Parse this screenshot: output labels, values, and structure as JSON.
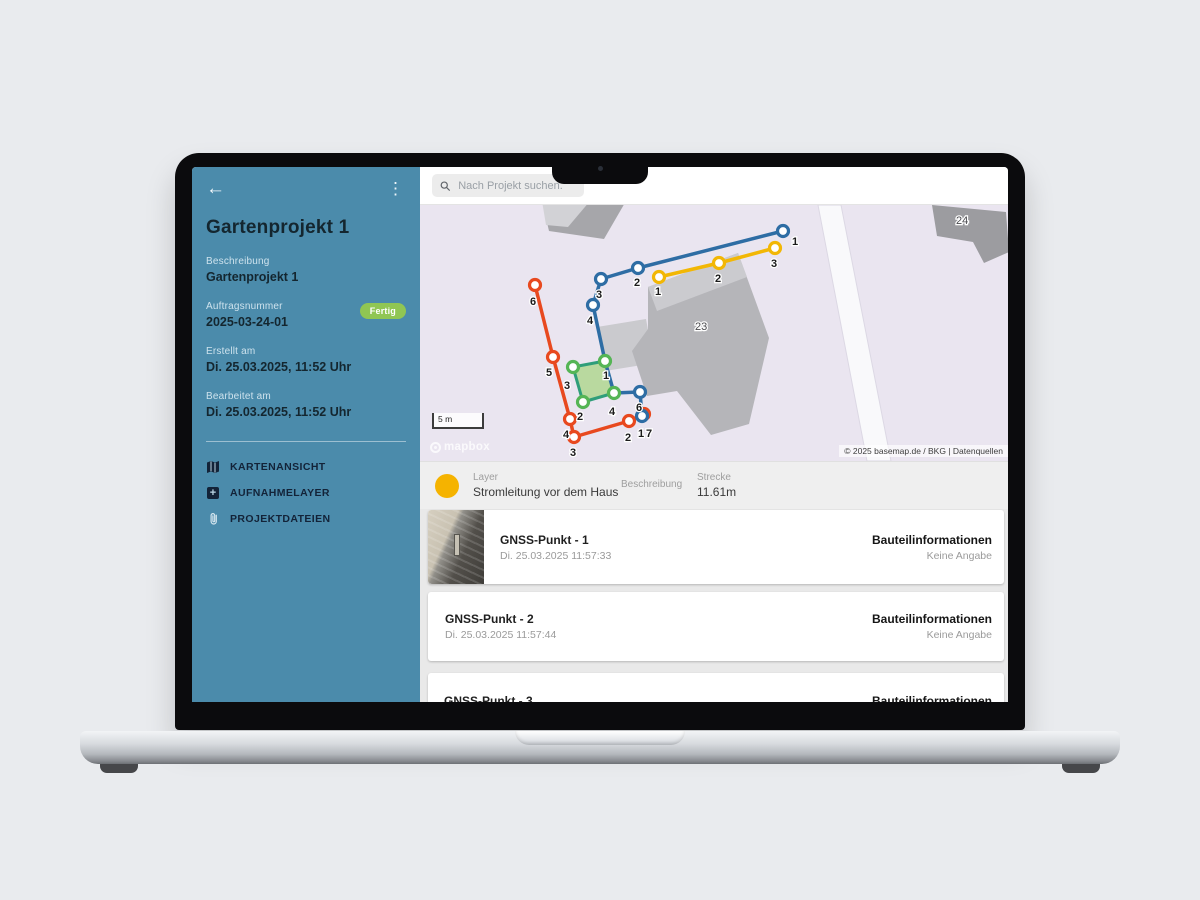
{
  "header": {
    "search_placeholder": "Nach Projekt suchen."
  },
  "sidebar": {
    "title": "Gartenprojekt 1",
    "fields": [
      {
        "label": "Beschreibung",
        "value": "Gartenprojekt 1"
      },
      {
        "label": "Auftragsnummer",
        "value": "2025-03-24-01",
        "badge": "Fertig"
      },
      {
        "label": "Erstellt am",
        "value": "Di. 25.03.2025, 11:52 Uhr"
      },
      {
        "label": "Bearbeitet am",
        "value": "Di. 25.03.2025, 11:52 Uhr"
      }
    ],
    "menu": [
      {
        "label": "KARTENANSICHT"
      },
      {
        "label": "AUFNAHMELAYER"
      },
      {
        "label": "PROJEKTDATEIEN"
      }
    ]
  },
  "map": {
    "scale_text": "5 m",
    "logo_text": "mapbox",
    "attribution": "© 2025 basemap.de / BKG | Datenquellen",
    "background": "#eae5f0",
    "building_labels": [
      {
        "text": "23",
        "x": 275,
        "y": 125
      },
      {
        "text": "24",
        "x": 536,
        "y": 19
      }
    ],
    "polygons": [
      {
        "name": "road",
        "points": [
          [
            398,
            0
          ],
          [
            421,
            0
          ],
          [
            471,
            256
          ],
          [
            447,
            256
          ]
        ],
        "fill": "#f9f9fb",
        "stroke": "#dcd8e4"
      },
      {
        "name": "building-a",
        "points": [
          [
            122,
            -4
          ],
          [
            206,
            -4
          ],
          [
            184,
            34
          ],
          [
            129,
            26
          ]
        ],
        "fill": "#a6a6aa"
      },
      {
        "name": "building-a-top",
        "points": [
          [
            122,
            -4
          ],
          [
            170,
            -4
          ],
          [
            148,
            22
          ],
          [
            126,
            20
          ]
        ],
        "fill": "#d2d2d6"
      },
      {
        "name": "annex",
        "points": [
          [
            177,
            122
          ],
          [
            226,
            114
          ],
          [
            234,
            158
          ],
          [
            185,
            166
          ]
        ],
        "fill": "#cacace"
      },
      {
        "name": "building-23",
        "points": [
          [
            228,
            82
          ],
          [
            318,
            48
          ],
          [
            349,
            133
          ],
          [
            329,
            219
          ],
          [
            291,
            230
          ],
          [
            257,
            186
          ],
          [
            227,
            191
          ],
          [
            212,
            146
          ],
          [
            228,
            124
          ]
        ],
        "fill": "#b5b5b9"
      },
      {
        "name": "building-23-top",
        "points": [
          [
            228,
            82
          ],
          [
            318,
            48
          ],
          [
            327,
            72
          ],
          [
            237,
            106
          ]
        ],
        "fill": "#cbcbcf"
      },
      {
        "name": "building-24",
        "points": [
          [
            512,
            0
          ],
          [
            586,
            7
          ],
          [
            589,
            47
          ],
          [
            564,
            58
          ],
          [
            553,
            37
          ],
          [
            517,
            31
          ]
        ],
        "fill": "#9c9ca0"
      }
    ],
    "green_polygon": {
      "fill": "rgba(170,214,136,0.78)",
      "stroke": "#2f9e7a",
      "vertex_color": "#55b555",
      "points": [
        [
          153,
          162
        ],
        [
          185,
          156
        ],
        [
          194,
          188
        ],
        [
          163,
          197
        ]
      ],
      "labels": [
        [
          "1",
          183,
          174
        ],
        [
          "3",
          144,
          184
        ],
        [
          "2",
          157,
          215
        ],
        [
          "4",
          189,
          210
        ]
      ]
    },
    "lines": [
      {
        "id": "red",
        "color": "#e8491f",
        "points": [
          [
            115,
            80
          ],
          [
            133,
            152
          ],
          [
            150,
            214
          ],
          [
            154,
            232
          ],
          [
            209,
            216
          ],
          [
            224,
            209
          ]
        ],
        "labels": [
          [
            "6",
            110,
            100
          ],
          [
            "5",
            126,
            171
          ],
          [
            "4",
            143,
            233
          ],
          [
            "3",
            150,
            251
          ],
          [
            "2",
            205,
            236
          ],
          [
            "1",
            218,
            232
          ]
        ]
      },
      {
        "id": "blue",
        "color": "#2e6da4",
        "points": [
          [
            363,
            26
          ],
          [
            218,
            63
          ],
          [
            181,
            74
          ],
          [
            173,
            100
          ],
          [
            185,
            156
          ],
          [
            194,
            188
          ],
          [
            220,
            187
          ],
          [
            222,
            211
          ]
        ],
        "vertices": [
          [
            363,
            26
          ],
          [
            218,
            63
          ],
          [
            181,
            74
          ],
          [
            173,
            100
          ],
          [
            220,
            187
          ],
          [
            222,
            211
          ]
        ],
        "labels": [
          [
            "1",
            372,
            40
          ],
          [
            "2",
            214,
            81
          ],
          [
            "3",
            176,
            93
          ],
          [
            "4",
            167,
            119
          ],
          [
            "6",
            216,
            206
          ],
          [
            "7",
            226,
            232
          ]
        ]
      },
      {
        "id": "yellow",
        "color": "#f2b705",
        "points": [
          [
            239,
            72
          ],
          [
            299,
            58
          ],
          [
            355,
            43
          ]
        ],
        "labels": [
          [
            "1",
            235,
            90
          ],
          [
            "2",
            295,
            77
          ],
          [
            "3",
            351,
            62
          ]
        ]
      }
    ]
  },
  "layer_summary": {
    "dot_color": "#f5b300",
    "layer_label": "Layer",
    "layer_value": "Stromleitung vor dem Haus",
    "beschreibung_label": "Beschreibung",
    "beschreibung_value": "",
    "strecke_label": "Strecke",
    "strecke_value": "11.61m"
  },
  "list": {
    "items": [
      {
        "title": "GNSS-Punkt - 1",
        "timestamp": "Di. 25.03.2025 11:57:33",
        "info_label": "Bauteilinformationen",
        "info_value": "Keine Angabe"
      },
      {
        "title": "GNSS-Punkt - 2",
        "timestamp": "Di. 25.03.2025 11:57:44",
        "info_label": "Bauteilinformationen",
        "info_value": "Keine Angabe"
      },
      {
        "title": "GNSS-Punkt - 3",
        "info_label": "Bauteilinformationen"
      }
    ]
  }
}
